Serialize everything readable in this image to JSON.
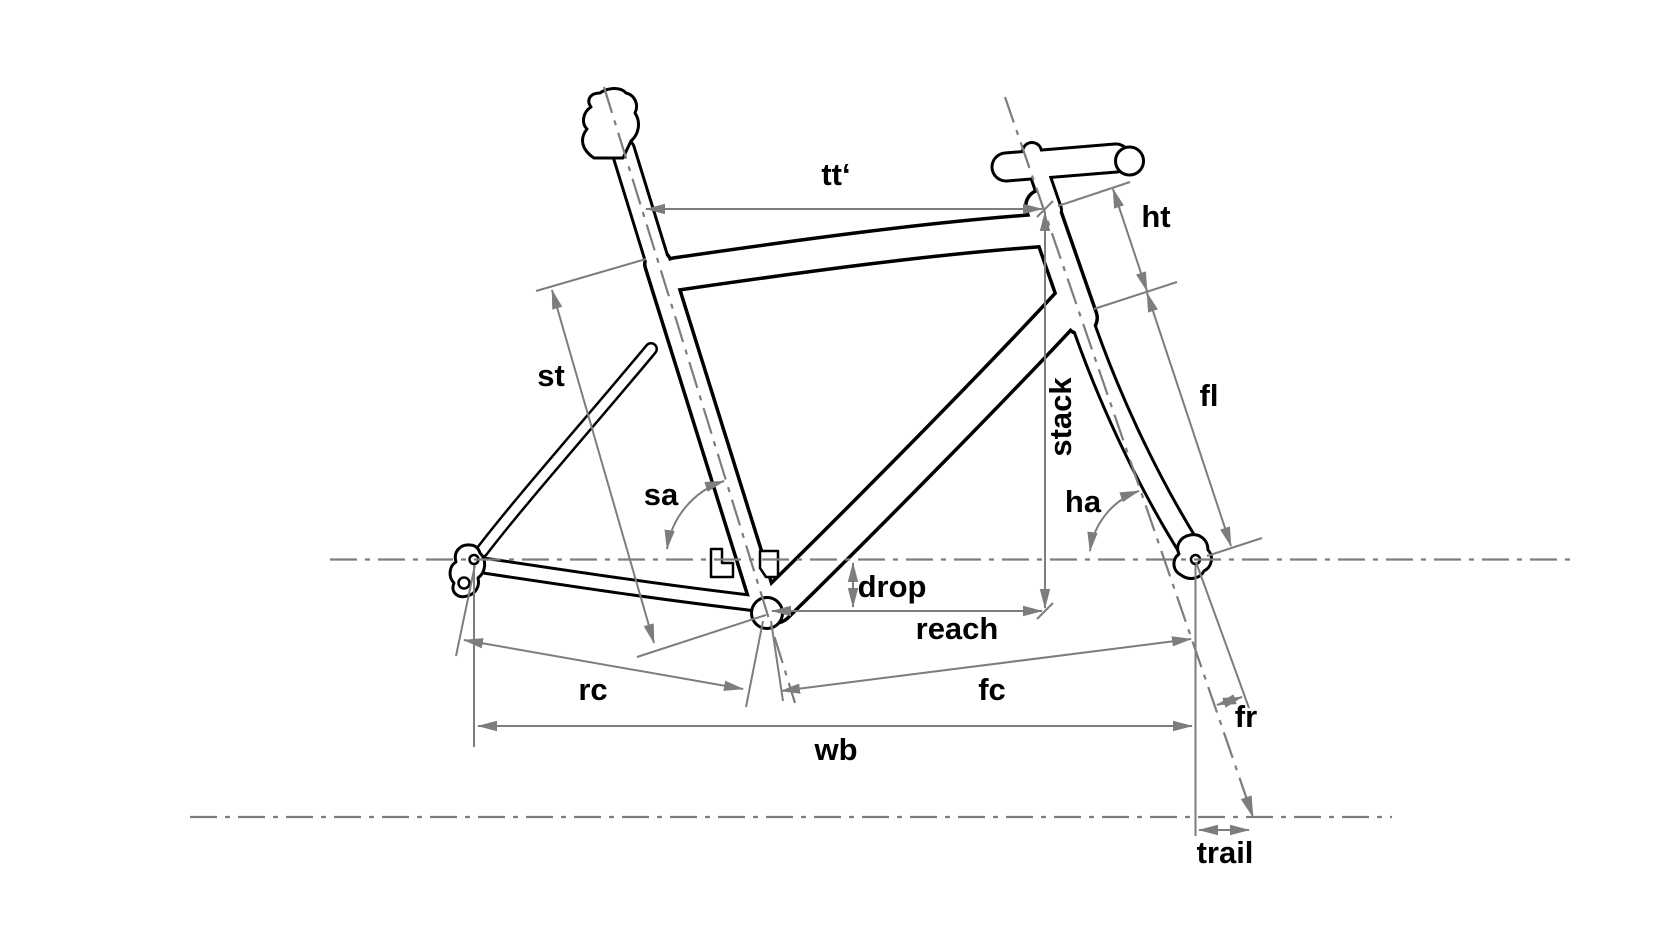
{
  "diagram": {
    "type": "bicycle-frame-geometry",
    "background_color": "#ffffff",
    "frame_outline_color": "#000000",
    "dimension_line_color": "#7d7d7d",
    "label_color": "#000000",
    "labels": {
      "tt": "tt‘",
      "ht": "ht",
      "st": "st",
      "fl": "fl",
      "sa": "sa",
      "ha": "ha",
      "stack": "stack",
      "drop": "drop",
      "reach": "reach",
      "rc": "rc",
      "fc": "fc",
      "wb": "wb",
      "fr": "fr",
      "trail": "trail"
    }
  }
}
